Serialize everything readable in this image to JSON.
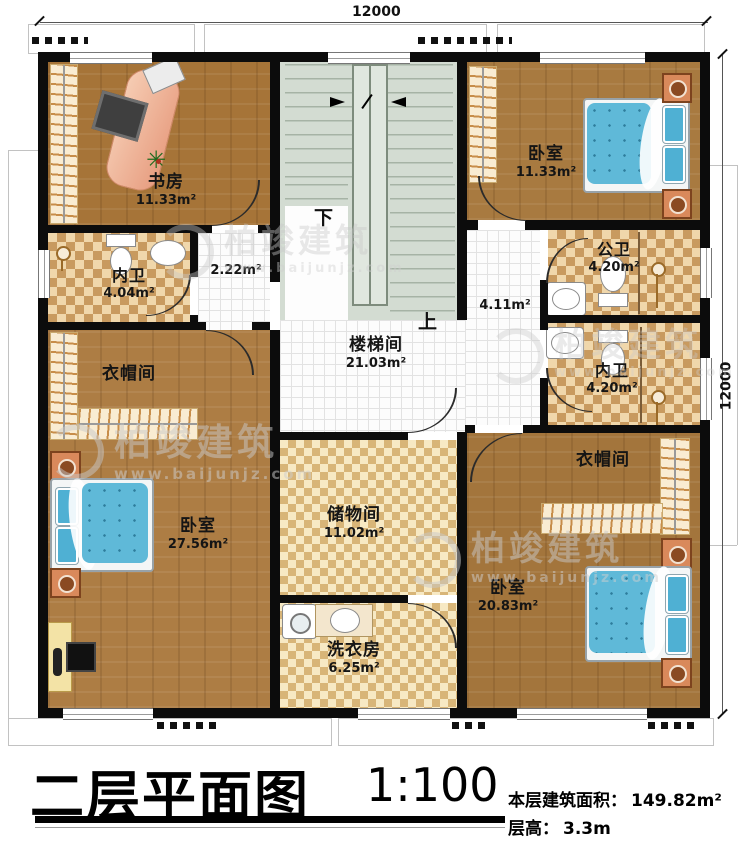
{
  "watermark": {
    "brand": "柏竣建筑",
    "url": "www.baijunjz.com"
  },
  "dims": {
    "top": "12000",
    "right": "12000"
  },
  "stairs": {
    "down": "下",
    "up": "上"
  },
  "rooms": {
    "study": {
      "name": "书房",
      "area": "11.33m²"
    },
    "bedroom_tr": {
      "name": "卧室",
      "area": "11.33m²"
    },
    "bath_inner_left": {
      "name": "内卫",
      "area": "4.04m²"
    },
    "hall_small": {
      "area": "2.22m²"
    },
    "bath_public": {
      "name": "公卫",
      "area": "4.20m²"
    },
    "hall_right": {
      "area": "4.11m²"
    },
    "bath_inner_right": {
      "name": "内卫",
      "area": "4.20m²"
    },
    "stairwell": {
      "name": "楼梯间",
      "area": "21.03m²"
    },
    "closet_left": {
      "name": "衣帽间"
    },
    "closet_right": {
      "name": "衣帽间"
    },
    "bedroom_bl": {
      "name": "卧室",
      "area": "27.56m²"
    },
    "storage": {
      "name": "储物间",
      "area": "11.02m²"
    },
    "laundry": {
      "name": "洗衣房",
      "area": "6.25m²"
    },
    "bedroom_br": {
      "name": "卧室",
      "area": "20.83m²"
    }
  },
  "titleblock": {
    "title": "二层平面图",
    "scale": "1:100",
    "area_label": "本层建筑面积：",
    "area_value": "149.82m²",
    "height_label": "层高：",
    "height_value": "3.3m"
  }
}
